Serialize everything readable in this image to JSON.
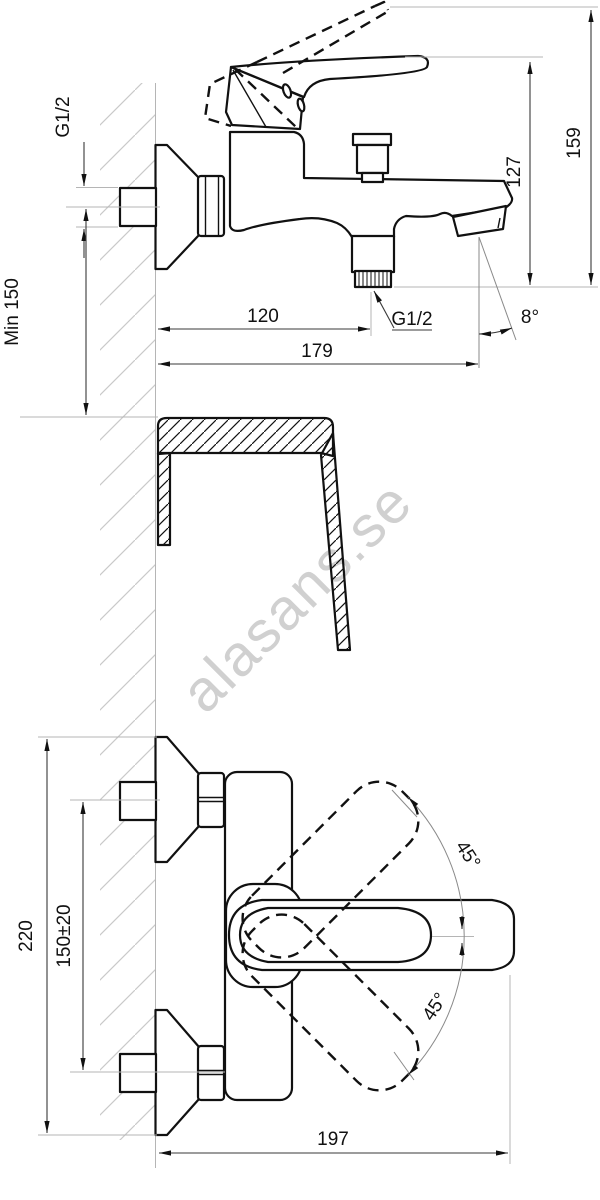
{
  "drawing": {
    "watermark": "alasans.se",
    "side_view": {
      "wall_thread_label": "G1/2",
      "min_height_label": "Min 150",
      "spout_projection": "120",
      "total_projection": "179",
      "outlet_thread_label": "G1/2",
      "height_to_spout": "127",
      "total_height": "159",
      "spout_angle": "8°"
    },
    "plan_view": {
      "total_width": "220",
      "inlet_spacing": "150±20",
      "total_depth": "197",
      "handle_swing_up": "45°",
      "handle_swing_down": "45°"
    },
    "colors": {
      "line": "#111111",
      "construction": "#b5b5b5",
      "watermark": "#cbcbcb",
      "background": "#ffffff"
    }
  }
}
